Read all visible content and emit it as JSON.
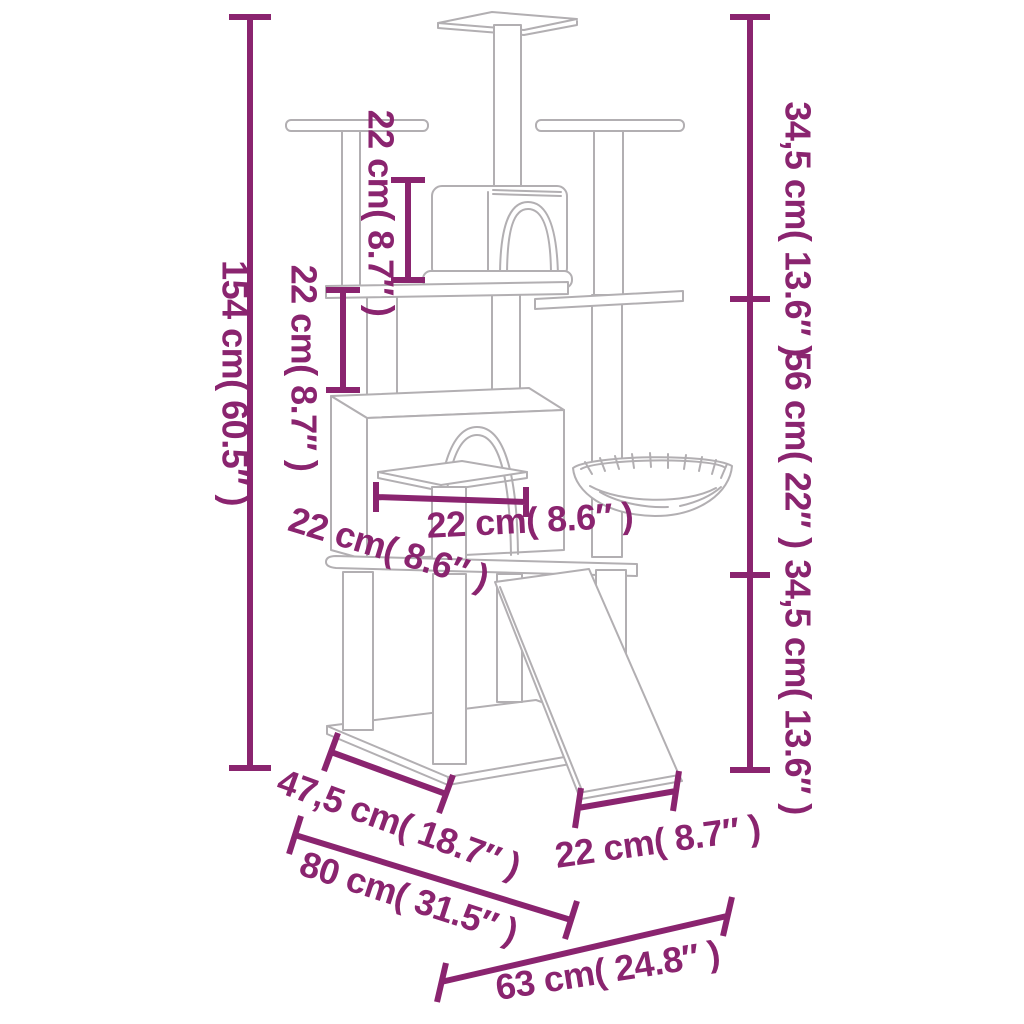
{
  "diagram": {
    "title": "cat-tree-with-scratching-posts-dimension-diagram",
    "colors": {
      "dimension_accent": "#8a246f",
      "drawing_outline": "#b2afb2",
      "background": "#ffffff"
    },
    "dims": {
      "total_height": "154 cm( 60.5″ )",
      "condo_height": "22 cm( 8.7″ )",
      "mid_post_height": "22 cm( 8.7″ )",
      "right_top_segment": "34,5 cm( 13.6″ )",
      "right_mid_segment": "56 cm( 22″ )",
      "right_bottom_segment": "34,5 cm( 13.6″ )",
      "stool_width": "22 cm( 8.6″ )",
      "stool_depth": "22 cm( 8.6″ )",
      "base_depth": "47,5 cm( 18.7″ )",
      "base_width": "80 cm( 31.5″ )",
      "ramp_width": "22 cm( 8.7″ )",
      "base_side": "63 cm( 24.8″ )"
    }
  }
}
